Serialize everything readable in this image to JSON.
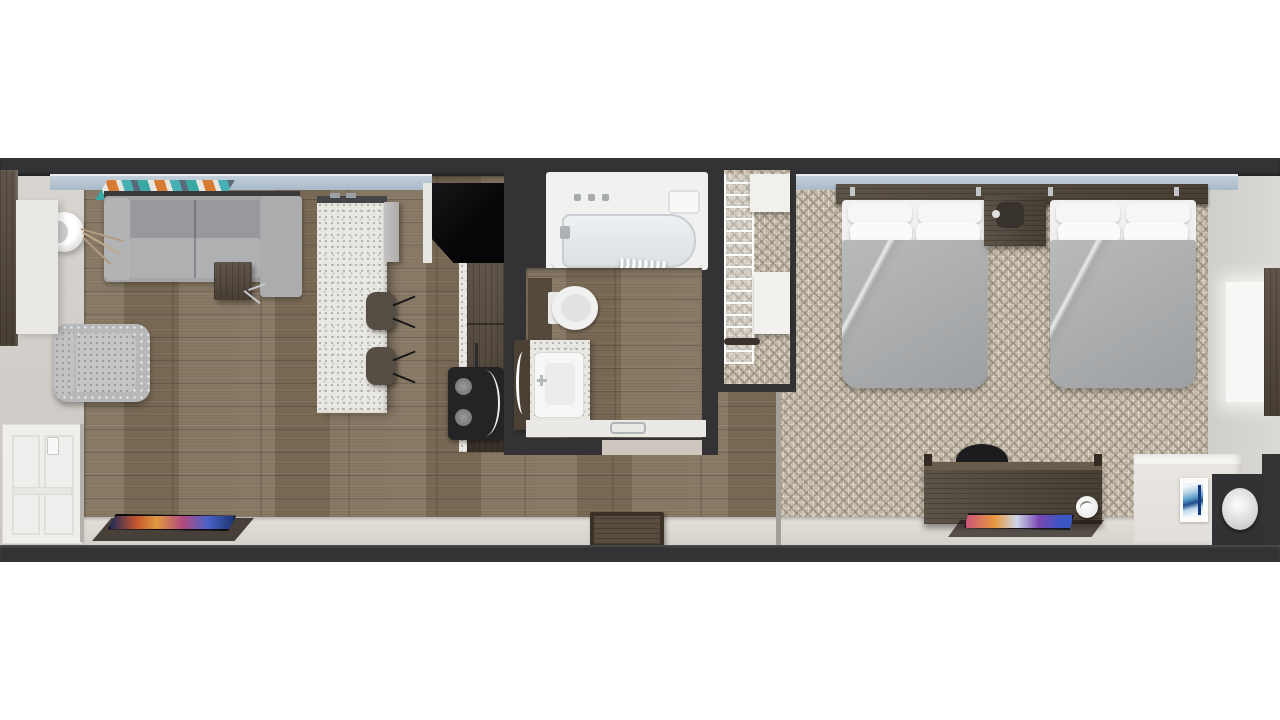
{
  "scene": {
    "title": "Hotel guest suite floor plan - top-down 3D rendering",
    "view": "top-down orthographic render, no visible text",
    "background": "#ffffff",
    "rooms": {
      "living": {
        "name": "Living room",
        "furniture": [
          "gray sectional sofa with chaise",
          "patterned accent armchair",
          "white floor lamp",
          "dark wood side table",
          "teal-orange wall art",
          "flat-screen TV on lower wall",
          "colorful TV screen"
        ]
      },
      "kitchen": {
        "name": "Kitchenette",
        "furniture": [
          "white quartz island",
          "island end cabinet",
          "two dark barstools",
          "black glossy counter",
          "dark wood base cabinets",
          "appliance unit with two burners"
        ]
      },
      "bathroom": {
        "name": "Bathroom",
        "furniture": [
          "bathtub with chrome fixtures",
          "curved shower rod and curtain",
          "soap shelf",
          "toilet",
          "speckled vanity with sink and mirror",
          "towel bar ledge",
          "door threshold"
        ]
      },
      "closet": {
        "name": "Closet",
        "furniture": [
          "white wire shelving",
          "top shelf",
          "storage box",
          "clothes rod"
        ]
      },
      "bedroom": {
        "name": "Bedroom",
        "furniture": [
          "queen bed 1 with gray duvet and four pillows",
          "queen bed 2 with gray duvet and four pillows",
          "shared dark wood headboard",
          "nightstand with lamp",
          "desk with chair",
          "flat-screen TV on lower wall",
          "white decor piece",
          "window light patch",
          "tall wardrobe"
        ]
      },
      "entry": {
        "name": "Entry nook",
        "furniture": [
          "white partition wall",
          "framed blue abstract art",
          "dark niche with round white stool",
          "wood tray on floor",
          "white paneled barn door",
          "left wardrobe panel",
          "white sliding panel"
        ]
      }
    },
    "colors": {
      "wall_charcoal": "#333335",
      "wood_floor": "#82725d",
      "carpet_beige": "#c4baa9",
      "carpet_pattern": "#786c5b",
      "walkway_tile": "#dbd7d1",
      "window_ledge_blue": "#b7c6d4",
      "island_quartz": "#e9e7e1",
      "sofa_gray": "#a3a5a7",
      "duvet_gray": "#aaacae",
      "pillow_white": "#f5f5f4",
      "dark_wood_furniture": "#52473b",
      "black_counter": "#0d0d0f",
      "tub_white": "#f1f1f0",
      "art_teal": "#3aa8a4",
      "art_orange": "#d97a33",
      "tv_screen_blue": "#3c55c5",
      "tv_screen_pink": "#c8507e",
      "painting_blue": "#1c4e8c",
      "barn_door_white": "#efeeec"
    }
  }
}
